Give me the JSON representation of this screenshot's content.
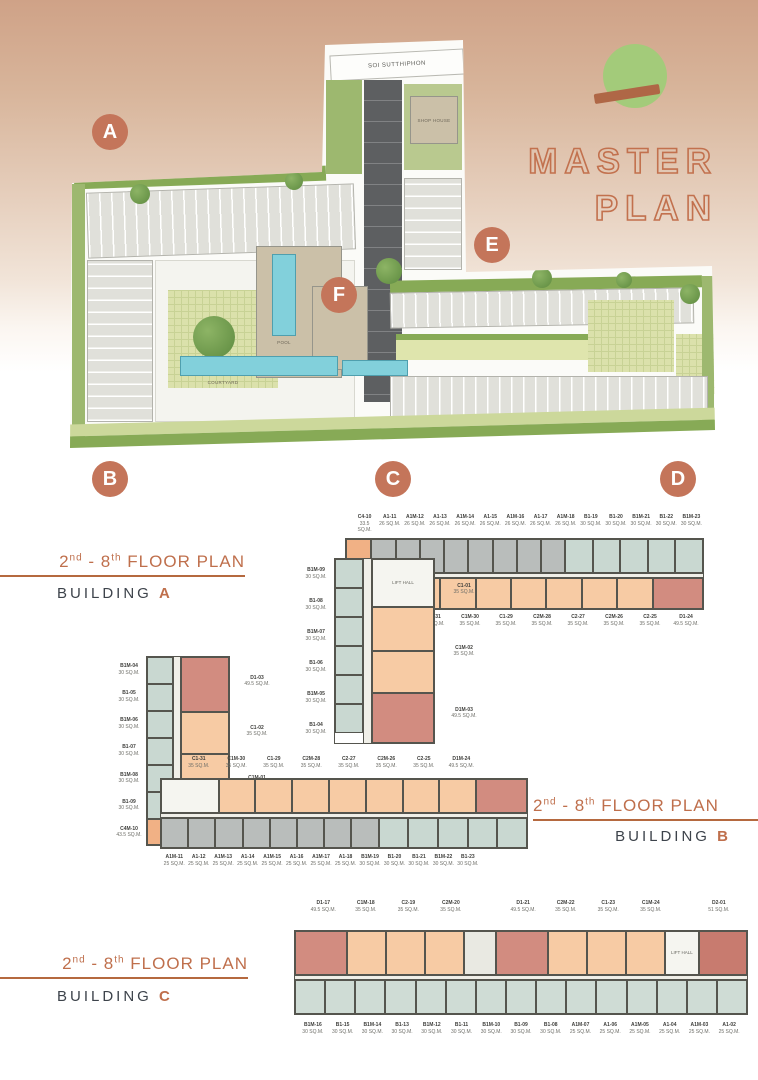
{
  "brand": {
    "logo_circle_color": "#a3cb7a",
    "logo_bar_color": "#af6746",
    "title_line1": "MASTER",
    "title_line2": "PLAN",
    "accent_color": "#bf6f4c"
  },
  "masterplan": {
    "road_label": "SOI SUTTHIPHON",
    "badge_color": "#c4755a",
    "badges": [
      {
        "letter": "A"
      },
      {
        "letter": "B"
      },
      {
        "letter": "C"
      },
      {
        "letter": "D"
      },
      {
        "letter": "E"
      },
      {
        "letter": "F"
      }
    ],
    "labels": {
      "shop_house": "SHOP HOUSE",
      "courtyard": "COURTYARD",
      "pool": "POOL"
    }
  },
  "sections": {
    "a": {
      "range": {
        "p1": "2",
        "s1": "nd",
        "p2": " - 8",
        "s2": "th",
        "p3": " FLOOR PLAN"
      },
      "building_word": "BUILDING",
      "letter": "A"
    },
    "b": {
      "range": {
        "p1": "2",
        "s1": "nd",
        "p2": " - 8",
        "s2": "th",
        "p3": " FLOOR PLAN"
      },
      "building_word": "BUILDING",
      "letter": "B"
    },
    "c": {
      "range": {
        "p1": "2",
        "s1": "nd",
        "p2": " - 8",
        "s2": "th",
        "p3": " FLOOR PLAN"
      },
      "building_word": "BUILDING",
      "letter": "C"
    }
  },
  "palette": {
    "gray": "#b9bdbb",
    "teal": "#c9d8d1",
    "tealLight": "#cfdcd5",
    "peach": "#f7cba4",
    "orange": "#f1b185",
    "rose": "#d28c80",
    "deeprose": "#c87b6f",
    "core": "#f5f5f0",
    "stair": "#e9e9e2"
  },
  "plans": {
    "a": {
      "top_labels": [
        {
          "code": "C4-10",
          "area": "33.5 SQ.M."
        },
        {
          "code": "A1-11",
          "area": "26 SQ.M."
        },
        {
          "code": "A1M-12",
          "area": "26 SQ.M."
        },
        {
          "code": "A1-13",
          "area": "26 SQ.M."
        },
        {
          "code": "A1M-14",
          "area": "26 SQ.M."
        },
        {
          "code": "A1-15",
          "area": "26 SQ.M."
        },
        {
          "code": "A1M-16",
          "area": "26 SQ.M."
        },
        {
          "code": "A1-17",
          "area": "26 SQ.M."
        },
        {
          "code": "A1M-18",
          "area": "26 SQ.M."
        },
        {
          "code": "B1-19",
          "area": "30 SQ.M."
        },
        {
          "code": "B1-20",
          "area": "30 SQ.M."
        },
        {
          "code": "B1M-21",
          "area": "30 SQ.M."
        },
        {
          "code": "B1-22",
          "area": "30 SQ.M."
        },
        {
          "code": "B1M-23",
          "area": "30 SQ.M."
        }
      ],
      "top_units": [
        {
          "color": "orange",
          "w": 1.05
        },
        {
          "color": "gray"
        },
        {
          "color": "gray"
        },
        {
          "color": "gray"
        },
        {
          "color": "gray"
        },
        {
          "color": "gray"
        },
        {
          "color": "gray"
        },
        {
          "color": "gray"
        },
        {
          "color": "gray"
        },
        {
          "color": "teal",
          "w": 1.15
        },
        {
          "color": "teal",
          "w": 1.15
        },
        {
          "color": "teal",
          "w": 1.15
        },
        {
          "color": "teal",
          "w": 1.15
        },
        {
          "color": "teal",
          "w": 1.15
        }
      ],
      "bottom_units": [
        {
          "color": "core",
          "w": 1.7
        },
        {
          "color": "peach"
        },
        {
          "color": "peach"
        },
        {
          "color": "peach"
        },
        {
          "color": "peach"
        },
        {
          "color": "peach"
        },
        {
          "color": "peach"
        },
        {
          "color": "peach"
        },
        {
          "color": "rose",
          "w": 1.45
        }
      ],
      "bottom_labels": [
        {
          "code": "C1-31",
          "area": "35 SQ.M."
        },
        {
          "code": "C1M-30",
          "area": "35 SQ.M."
        },
        {
          "code": "C1-29",
          "area": "35 SQ.M."
        },
        {
          "code": "C2M-28",
          "area": "35 SQ.M."
        },
        {
          "code": "C2-27",
          "area": "35 SQ.M."
        },
        {
          "code": "C2M-26",
          "area": "35 SQ.M."
        },
        {
          "code": "C2-25",
          "area": "35 SQ.M."
        },
        {
          "code": "D1-24",
          "area": "49.5 SQ.M."
        }
      ],
      "wing_left_labels": [
        {
          "code": "B1M-09",
          "area": "30 SQ.M."
        },
        {
          "code": "B1-08",
          "area": "30 SQ.M."
        },
        {
          "code": "B1M-07",
          "area": "30 SQ.M."
        },
        {
          "code": "B1-06",
          "area": "30 SQ.M."
        },
        {
          "code": "B1M-05",
          "area": "30 SQ.M."
        },
        {
          "code": "B1-04",
          "area": "30 SQ.M."
        }
      ],
      "wing_left_units": [
        {
          "color": "teal",
          "h": 29
        },
        {
          "color": "teal",
          "h": 29
        },
        {
          "color": "teal",
          "h": 29
        },
        {
          "color": "teal",
          "h": 29
        },
        {
          "color": "teal",
          "h": 29
        },
        {
          "color": "teal",
          "h": 29
        }
      ],
      "wing_right_units": [
        {
          "color": "core",
          "h": 48,
          "label": "LIFT HALL"
        },
        {
          "color": "peach",
          "h": 44
        },
        {
          "color": "peach",
          "h": 42
        },
        {
          "color": "rose",
          "h": 50
        }
      ],
      "wing_right_labels": [
        {
          "code": "C1-01",
          "area": "35 SQ.M."
        },
        {
          "code": "C1M-02",
          "area": "35 SQ.M."
        },
        {
          "code": "D1M-03",
          "area": "49.5 SQ.M."
        }
      ]
    },
    "b": {
      "wing_left_labels": [
        {
          "code": "B1M-04",
          "area": "30 SQ.M."
        },
        {
          "code": "B1-05",
          "area": "30 SQ.M."
        },
        {
          "code": "B1M-06",
          "area": "30 SQ.M."
        },
        {
          "code": "B1-07",
          "area": "30 SQ.M."
        },
        {
          "code": "B1M-08",
          "area": "30 SQ.M."
        },
        {
          "code": "B1-09",
          "area": "30 SQ.M."
        },
        {
          "code": "C4M-10",
          "area": "43.5 SQ.M."
        }
      ],
      "wing_left_units": [
        {
          "color": "teal",
          "h": 27
        },
        {
          "color": "teal",
          "h": 27
        },
        {
          "color": "teal",
          "h": 27
        },
        {
          "color": "teal",
          "h": 27
        },
        {
          "color": "teal",
          "h": 27
        },
        {
          "color": "teal",
          "h": 27
        },
        {
          "color": "orange",
          "h": 26
        }
      ],
      "wing_right_units": [
        {
          "color": "rose",
          "h": 56
        },
        {
          "color": "peach",
          "h": 42
        },
        {
          "color": "peach",
          "h": 44
        },
        {
          "color": "core",
          "h": 40,
          "label": "LIFT HALL"
        }
      ],
      "wing_right_labels": [
        {
          "code": "D1-03",
          "area": "49.5 SQ.M."
        },
        {
          "code": "C1-02",
          "area": "35 SQ.M."
        },
        {
          "code": "C1M-01",
          "area": "35 SQ.M."
        }
      ],
      "top_labels": [
        {
          "code": "C1-31",
          "area": "35 SQ.M."
        },
        {
          "code": "C1M-30",
          "area": "35 SQ.M."
        },
        {
          "code": "C1-29",
          "area": "35 SQ.M."
        },
        {
          "code": "C2M-28",
          "area": "35 SQ.M."
        },
        {
          "code": "C2-27",
          "area": "35 SQ.M."
        },
        {
          "code": "C2M-26",
          "area": "35 SQ.M."
        },
        {
          "code": "C2-25",
          "area": "35 SQ.M."
        },
        {
          "code": "D1M-24",
          "area": "49.5 SQ.M."
        }
      ],
      "top_units": [
        {
          "color": "core",
          "w": 1.6
        },
        {
          "color": "peach"
        },
        {
          "color": "peach"
        },
        {
          "color": "peach"
        },
        {
          "color": "peach"
        },
        {
          "color": "peach"
        },
        {
          "color": "peach"
        },
        {
          "color": "peach"
        },
        {
          "color": "rose",
          "w": 1.4
        }
      ],
      "bottom_units": [
        {
          "color": "gray"
        },
        {
          "color": "gray"
        },
        {
          "color": "gray"
        },
        {
          "color": "gray"
        },
        {
          "color": "gray"
        },
        {
          "color": "gray"
        },
        {
          "color": "gray"
        },
        {
          "color": "gray"
        },
        {
          "color": "teal",
          "w": 1.1
        },
        {
          "color": "teal",
          "w": 1.1
        },
        {
          "color": "teal",
          "w": 1.1
        },
        {
          "color": "teal",
          "w": 1.1
        },
        {
          "color": "teal",
          "w": 1.1
        }
      ],
      "bottom_labels": [
        {
          "code": "A1M-11",
          "area": "25 SQ.M."
        },
        {
          "code": "A1-12",
          "area": "25 SQ.M."
        },
        {
          "code": "A1M-13",
          "area": "25 SQ.M."
        },
        {
          "code": "A1-14",
          "area": "25 SQ.M."
        },
        {
          "code": "A1M-15",
          "area": "25 SQ.M."
        },
        {
          "code": "A1-16",
          "area": "25 SQ.M."
        },
        {
          "code": "A1M-17",
          "area": "25 SQ.M."
        },
        {
          "code": "A1-18",
          "area": "25 SQ.M."
        },
        {
          "code": "B1M-19",
          "area": "30 SQ.M."
        },
        {
          "code": "B1-20",
          "area": "30 SQ.M."
        },
        {
          "code": "B1-21",
          "area": "30 SQ.M."
        },
        {
          "code": "B1M-22",
          "area": "30 SQ.M."
        },
        {
          "code": "B1-23",
          "area": "30 SQ.M."
        }
      ]
    },
    "c": {
      "top_labels": [
        {
          "code": "D1-17",
          "area": "49.5 SQ.M."
        },
        {
          "code": "C1M-18",
          "area": "35 SQ.M."
        },
        {
          "code": "C2-19",
          "area": "35 SQ.M."
        },
        {
          "code": "C2M-20",
          "area": "35 SQ.M."
        },
        {
          "spacer": true,
          "w": 0.7
        },
        {
          "code": "D1-21",
          "area": "49.5 SQ.M."
        },
        {
          "code": "C2M-22",
          "area": "35 SQ.M."
        },
        {
          "code": "C1-23",
          "area": "35 SQ.M."
        },
        {
          "code": "C1M-24",
          "area": "35 SQ.M."
        },
        {
          "spacer": true,
          "w": 0.6
        },
        {
          "code": "D2-01",
          "area": "51 SQ.M."
        }
      ],
      "top_units": [
        {
          "color": "rose",
          "w": 1.35
        },
        {
          "color": "peach"
        },
        {
          "color": "peach"
        },
        {
          "color": "peach"
        },
        {
          "color": "stair",
          "w": 0.8
        },
        {
          "color": "rose",
          "w": 1.35
        },
        {
          "color": "peach"
        },
        {
          "color": "peach"
        },
        {
          "color": "peach"
        },
        {
          "color": "core",
          "w": 0.85,
          "label": "LIFT HALL"
        },
        {
          "color": "deeprose",
          "w": 1.25
        }
      ],
      "bottom_units": [
        {
          "color": "tealLight"
        },
        {
          "color": "tealLight"
        },
        {
          "color": "tealLight"
        },
        {
          "color": "tealLight"
        },
        {
          "color": "tealLight"
        },
        {
          "color": "tealLight"
        },
        {
          "color": "tealLight"
        },
        {
          "color": "tealLight"
        },
        {
          "color": "tealLight"
        },
        {
          "color": "tealLight"
        },
        {
          "color": "tealLight"
        },
        {
          "color": "tealLight"
        },
        {
          "color": "tealLight"
        },
        {
          "color": "tealLight"
        },
        {
          "color": "tealLight"
        }
      ],
      "bottom_labels": [
        {
          "code": "B1M-16",
          "area": "30 SQ.M."
        },
        {
          "code": "B1-15",
          "area": "30 SQ.M."
        },
        {
          "code": "B1M-14",
          "area": "30 SQ.M."
        },
        {
          "code": "B1-13",
          "area": "30 SQ.M."
        },
        {
          "code": "B1M-12",
          "area": "30 SQ.M."
        },
        {
          "code": "B1-11",
          "area": "30 SQ.M."
        },
        {
          "code": "B1M-10",
          "area": "30 SQ.M."
        },
        {
          "code": "B1-09",
          "area": "30 SQ.M."
        },
        {
          "code": "B1-08",
          "area": "30 SQ.M."
        },
        {
          "code": "A1M-07",
          "area": "25 SQ.M."
        },
        {
          "code": "A1-06",
          "area": "25 SQ.M."
        },
        {
          "code": "A1M-05",
          "area": "25 SQ.M."
        },
        {
          "code": "A1-04",
          "area": "25 SQ.M."
        },
        {
          "code": "A1M-03",
          "area": "25 SQ.M."
        },
        {
          "code": "A1-02",
          "area": "25 SQ.M."
        }
      ]
    }
  }
}
